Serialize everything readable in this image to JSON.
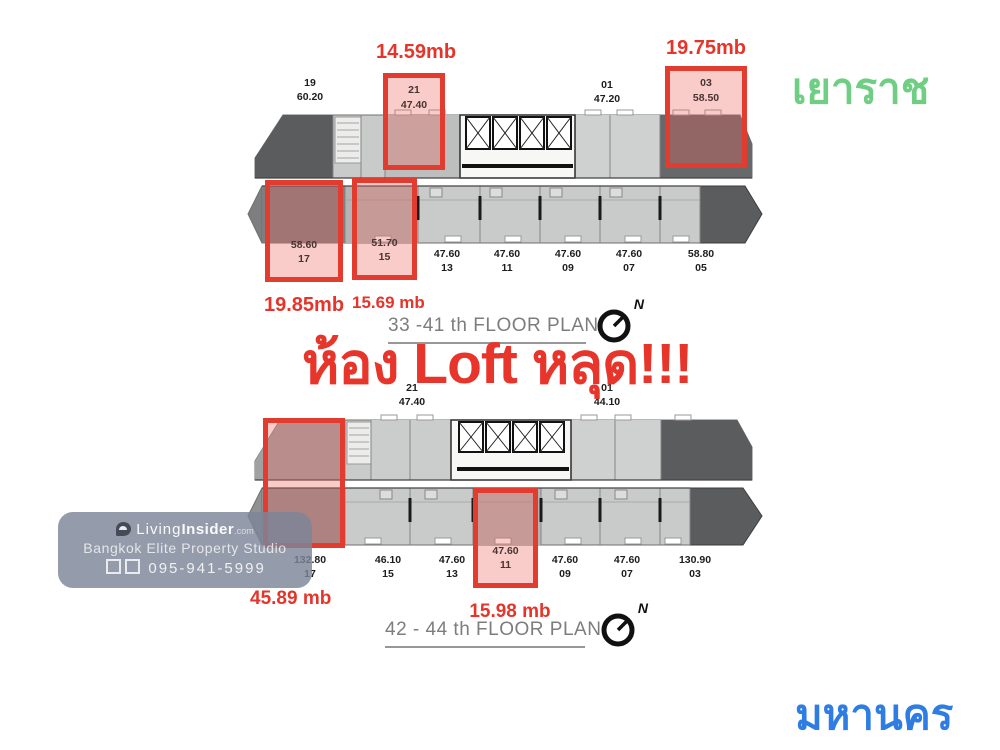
{
  "headline": "ห้อง Loft หลุด!!!",
  "district_top": "เยาราช",
  "district_bottom": "มหานคร",
  "compass_north": "N",
  "plan1": {
    "title": "33 -41 th FLOOR PLAN",
    "top_labels": [
      {
        "no": "19",
        "area": "60.20"
      },
      {
        "no": "01",
        "area": "47.20"
      }
    ],
    "boxes": {
      "unit21": {
        "no": "21",
        "area": "47.40",
        "price": "14.59mb"
      },
      "unit03": {
        "no": "03",
        "area": "58.50",
        "price": "19.75mb"
      },
      "unit17": {
        "no": "17",
        "area": "58.60",
        "price": "19.85mb"
      },
      "unit15": {
        "no": "15",
        "area": "51.70",
        "price": "15.69 mb"
      }
    },
    "bottom_labels": [
      {
        "area": "47.60",
        "no": "13"
      },
      {
        "area": "47.60",
        "no": "11"
      },
      {
        "area": "47.60",
        "no": "09"
      },
      {
        "area": "47.60",
        "no": "07"
      },
      {
        "area": "58.80",
        "no": "05"
      }
    ]
  },
  "plan2": {
    "title": "42 - 44 th FLOOR PLAN",
    "top_labels": [
      {
        "no": "21",
        "area": "47.40"
      },
      {
        "no": "01",
        "area": "44.10"
      }
    ],
    "boxes": {
      "unit17": {
        "no": "17",
        "area": "132.80",
        "price": "45.89 mb"
      },
      "unit11": {
        "no": "11",
        "area": "47.60",
        "price": "15.98 mb"
      }
    },
    "bottom_labels": [
      {
        "area": "132.80",
        "no": "17"
      },
      {
        "area": "46.10",
        "no": "15"
      },
      {
        "area": "47.60",
        "no": "13"
      },
      {
        "area": "47.60",
        "no": "09"
      },
      {
        "area": "47.60",
        "no": "07"
      },
      {
        "area": "130.90",
        "no": "03"
      }
    ]
  },
  "watermark": {
    "brand_first": "Living",
    "brand_second": "Insider",
    "brand_tld": ".com",
    "studio_line": "Bangkok Elite Property Studio",
    "phone": "095-941-5999"
  },
  "colors": {
    "highlight_red": "#e23b30",
    "text_red": "#e5352b",
    "district_green": "#6fce83",
    "district_blue": "#2d7de2",
    "plan_gray_light": "#c9cbca",
    "plan_gray_dark": "#5b5c5e"
  }
}
